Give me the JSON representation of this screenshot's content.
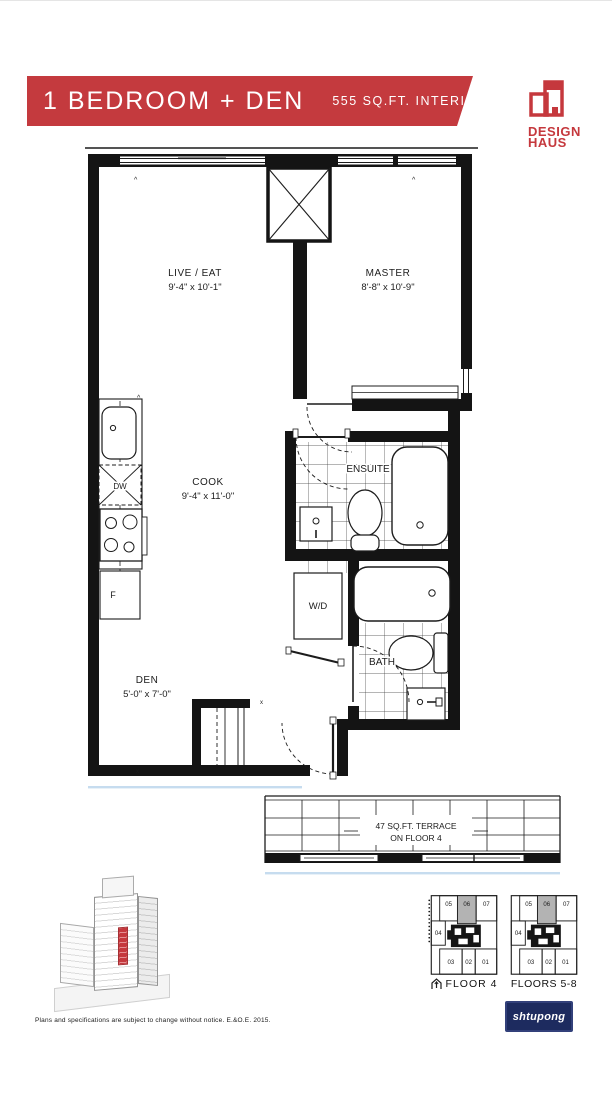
{
  "header": {
    "title": "1 BEDROOM + DEN",
    "area": "555 SQ.FT. INTERIOR",
    "unit_code": "1G+D2",
    "banner_color": "#c43a3e"
  },
  "logo": {
    "line1": "DESIGN",
    "line2": "HAUS",
    "color": "#c5383d"
  },
  "floor_plan": {
    "live_eat": {
      "name": "LIVE / EAT",
      "dims": "9'-4\" x 10'-1\""
    },
    "master": {
      "name": "MASTER",
      "dims": "8'-8\" x 10'-9\""
    },
    "cook": {
      "name": "COOK",
      "dims": "9'-4\" x 11'-0\""
    },
    "den": {
      "name": "DEN",
      "dims": "5'-0\" x 7'-0\""
    },
    "ensuite": {
      "name": "ENSUITE"
    },
    "bath": {
      "name": "BATH"
    },
    "laundry": {
      "name": "W/D"
    },
    "dishwasher": "DW",
    "fridge": "F",
    "terrace_line1": "47 SQ.FT. TERRACE",
    "terrace_line2": "ON FLOOR 4"
  },
  "keyplates": {
    "floor4_label": "FLOOR 4",
    "floors58_label": "FLOORS 5-8",
    "units": [
      "05",
      "06",
      "07",
      "04",
      "03",
      "02",
      "01"
    ],
    "highlighted_unit": "06",
    "highlight_color": "#b3b3b3"
  },
  "footer": {
    "disclaimer": "Plans and specifications are subject to change without notice. E.&O.E. 2015.",
    "watermark": "shtupong",
    "watermark_bg": "#1d2b5f"
  }
}
